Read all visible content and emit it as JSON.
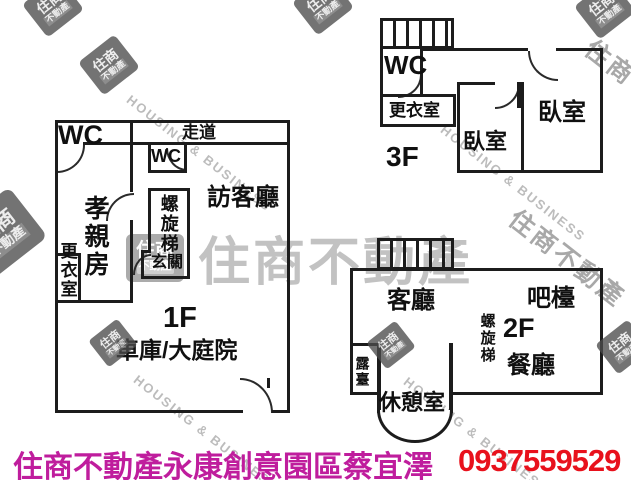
{
  "floors": {
    "f1": {
      "label": "1F",
      "wc_main": "WC",
      "corridor": "走道",
      "wc_small": "WC",
      "visitor_room": "訪客廳",
      "parent_room": "孝親房",
      "dressing_room": "更衣室",
      "spiral_stair": "螺旋梯",
      "foyer": "玄關",
      "garage_yard": "車庫/大庭院"
    },
    "f2": {
      "label": "2F",
      "living_room": "客廳",
      "bar_counter": "吧檯",
      "spiral_stair": "螺旋梯",
      "dining_room": "餐廳",
      "terrace": "露臺",
      "lounge": "休憩室"
    },
    "f3": {
      "label": "3F",
      "wc": "WC",
      "dressing_room": "更衣室",
      "bedroom_left": "臥室",
      "bedroom_right": "臥室"
    }
  },
  "watermark": {
    "brand_cn": "住商不動產",
    "brand_en": "HOUSING & BUSINESS",
    "seal_line1": "住商",
    "seal_line2": "不動產",
    "gray": "#9a9a9a"
  },
  "footer": {
    "agency": "住商不動產永康創意園區蔡宜澤",
    "phone": "0937559529",
    "agency_color": "#bf1d9d",
    "phone_color": "#e8111c"
  }
}
